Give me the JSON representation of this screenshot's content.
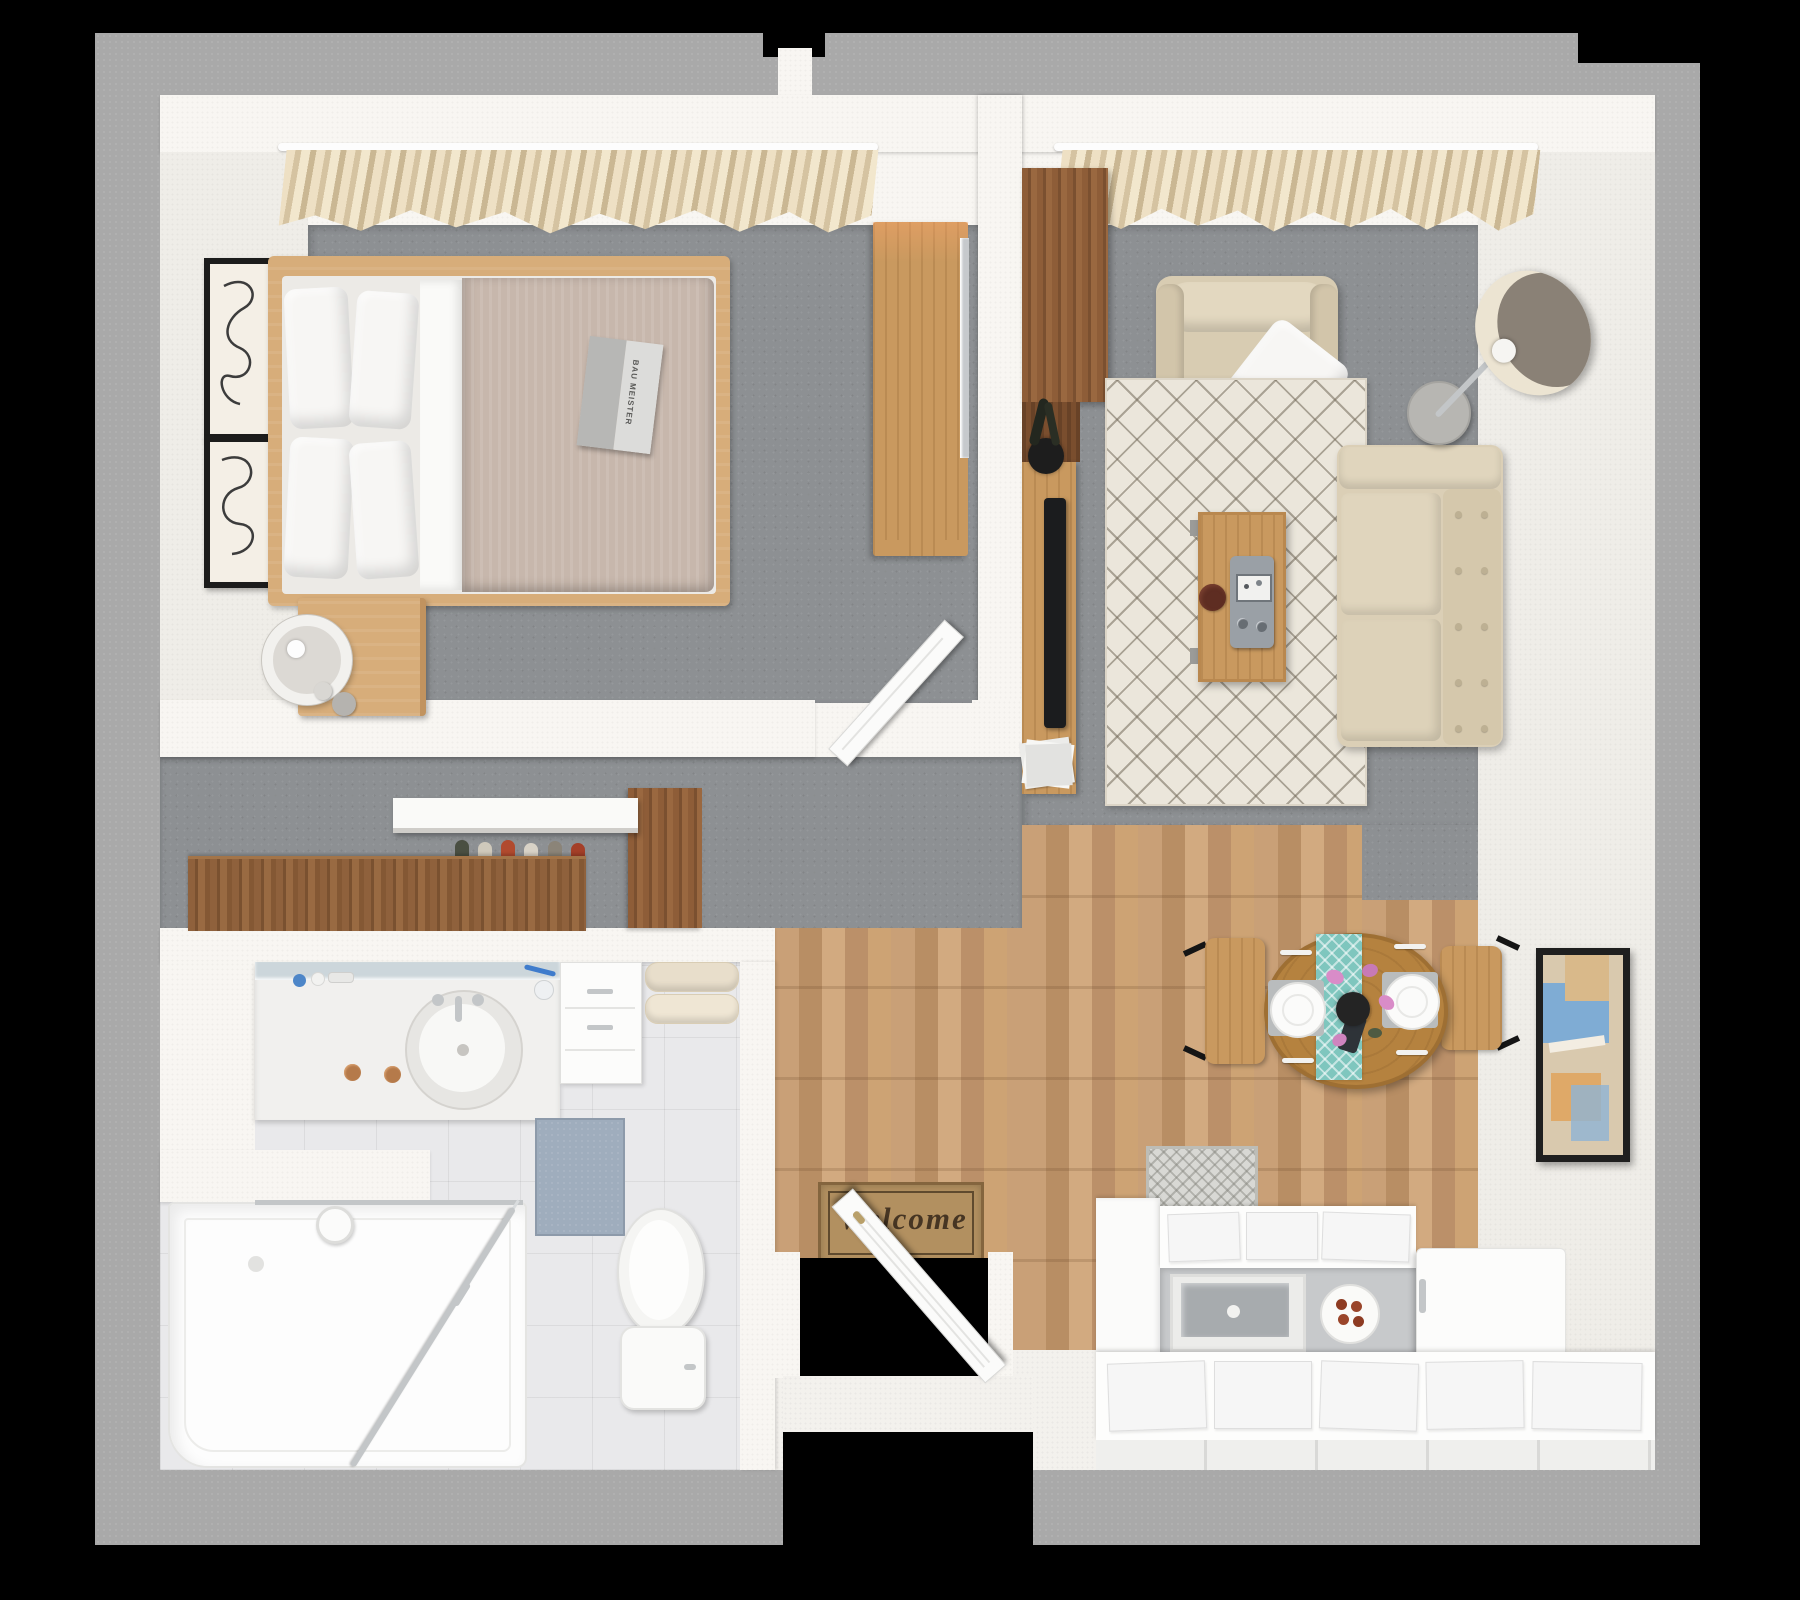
{
  "scene": {
    "type": "3d-floor-plan-top-view",
    "subject": "one-bedroom apartment with bedroom, living room, closet hall, bathroom, entry, dining area and kitchen"
  },
  "texts": {
    "welcome_mat": "Welcome",
    "book_title": "BAU MEISTER"
  },
  "palette": {
    "background": "#000000",
    "concrete_border": "#a9a9a9",
    "interior_wall": "#f8f6f2",
    "carpet_gray": "#8d9093",
    "wood_floor": "#c49a6f",
    "bathroom_tile": "#e9e9eb",
    "oak_furniture": "#d7ad7a",
    "walnut_furniture": "#8d5f3a",
    "sofa_beige": "#dbcfb6",
    "duvet_taupe": "#c7b7ac",
    "rug_cream": "#ebe6db",
    "runner_teal": "#7fc6be",
    "mat_brown": "#b29060",
    "bath_mat_blue": "#9fadbd",
    "art_blue": "#74a9d8",
    "art_tan": "#d9b98a",
    "art_orange": "#dfa35c"
  },
  "rooms": [
    {
      "id": "bedroom",
      "furniture": [
        "double-bed",
        "pillows",
        "duvet",
        "open-book",
        "nightstand",
        "table-lamp",
        "wall-art-frames",
        "window-curtains",
        "dresser",
        "leaning-mirror",
        "open-door"
      ]
    },
    {
      "id": "living-room",
      "furniture": [
        "tall-cabinet",
        "tv-console",
        "flat-tv",
        "plant-vase",
        "magazines",
        "armchair",
        "throw-pillow",
        "area-rug",
        "coffee-table",
        "radio-device",
        "bowl",
        "sofa",
        "floor-lamp",
        "round-side-table",
        "window-curtains"
      ]
    },
    {
      "id": "closet-hall",
      "furniture": [
        "walnut-sideboard",
        "shoes-row",
        "wall-shelf",
        "wardrobe-block"
      ]
    },
    {
      "id": "bathroom",
      "furniture": [
        "vanity-counter",
        "oval-sink",
        "mirror-strip",
        "storage-cabinet",
        "towels",
        "bath-mat",
        "toilet",
        "walk-in-shower"
      ]
    },
    {
      "id": "entry",
      "furniture": [
        "welcome-mat",
        "entry-door",
        "door-threshold"
      ]
    },
    {
      "id": "dining",
      "furniture": [
        "round-table",
        "table-runner",
        "place-settings",
        "flower-vase",
        "dining-chairs"
      ]
    },
    {
      "id": "kitchen",
      "furniture": [
        "counter-runs",
        "cabinet-doors",
        "glass-front-oven",
        "plate-of-cookies",
        "refrigerator",
        "kitchen-mat",
        "wall-art"
      ]
    }
  ]
}
